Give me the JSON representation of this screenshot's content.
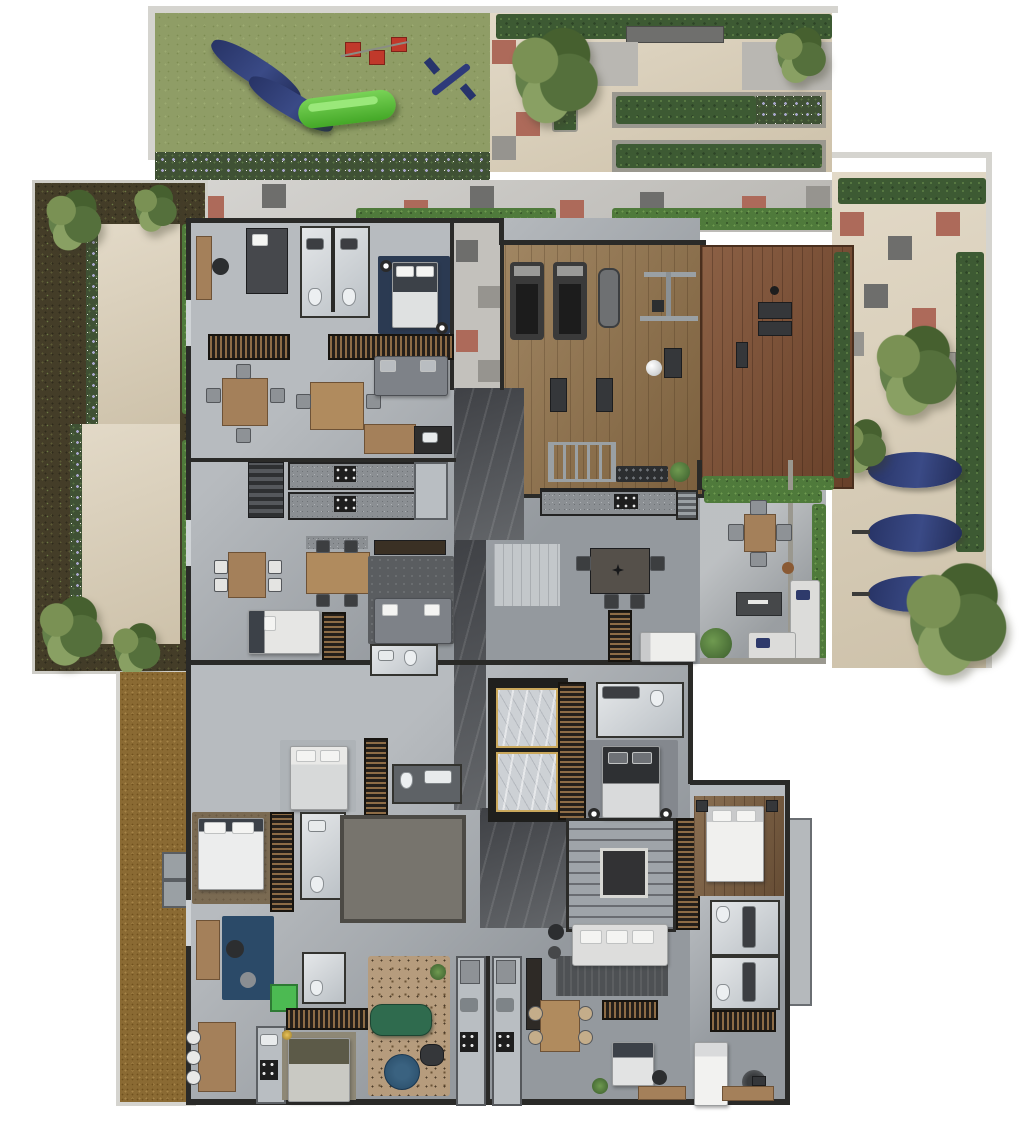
{
  "image_type": "architectural-floor-plan-render",
  "orientation": "top-down",
  "palette": {
    "page_bg": "#ffffff",
    "grass": "#8f9d66",
    "hedge_dark": "#3d5a33",
    "hedge_bright": "#4f7a3b",
    "garden_shrubs": "#443d28",
    "gravel_mulch": "#8a6a33",
    "paving_beige": "#d9cdb5",
    "paving_gray": "#c6c4bf",
    "tile_red": "#ad6a5a",
    "tile_dark": "#6b6b69",
    "concrete_floor": "#a3a8ad",
    "walls": "#2a2a28",
    "gym_wood": "#8d6f49",
    "deck_wood": "#7c4e33",
    "marble_dark": "#56595d",
    "marble_light": "#cdd1d5",
    "navy_fabric": "#2e3a6b",
    "rug_navy": "#2b3a52",
    "rug_office_blue": "#2b4a68",
    "sofa_green": "#2f6b4e",
    "cabinet_green": "#4cba52",
    "slide_green": "#5abe3c",
    "swing_red": "#c0392b",
    "furniture_wood": "#a4805a"
  },
  "outdoor_areas": {
    "playground": {
      "surface": "grass",
      "items": [
        "blue-lounger",
        "blue-lounger",
        "green-slide",
        "swing-red-seat",
        "swing-red-seat",
        "swing-red-seat",
        "seesaw"
      ]
    },
    "top_patio": {
      "surface": "beige-paving",
      "items": [
        "hedge-row",
        "bench",
        "tree",
        "planter",
        "planter",
        "planter"
      ]
    },
    "right_patio": {
      "surface": "beige-paving",
      "items": [
        "hedge-row",
        "checker-tiles",
        "bench",
        "navy-lounger",
        "navy-lounger",
        "navy-lounger",
        "tree",
        "tree",
        "tree"
      ]
    },
    "left_garden": {
      "surface": "shrub-bed",
      "items": [
        "palm",
        "palm",
        "palm",
        "palm",
        "terrace-path",
        "flower-border",
        "flower-border"
      ]
    },
    "mulch_strip": {
      "surface": "brown-gravel",
      "items": [
        "ac-pad",
        "ac-pad"
      ]
    },
    "lounge_terrace": {
      "surface": "concrete",
      "items": [
        "outdoor-table",
        "chairs-4",
        "fire-pit",
        "l-sofa-white",
        "plant"
      ]
    }
  },
  "indoor_areas": {
    "gym": {
      "floor": "light-wood",
      "items": [
        "treadmill",
        "treadmill",
        "elliptical",
        "cable-station",
        "exercise-mat",
        "exercise-mat",
        "gym-ball",
        "ladder-rack",
        "dumbbell-rack",
        "plant"
      ]
    },
    "yoga_deck": {
      "floor": "dark-wood",
      "items": [
        "yoga-mat",
        "yoga-mat",
        "hedge-border"
      ]
    },
    "corridor": {
      "floor": "dark-marble",
      "items": [
        "checker-hallway"
      ]
    },
    "core": {
      "items": [
        "elevator",
        "elevator",
        "switchback-stairs"
      ]
    },
    "apartments": [
      {
        "id": "top-left",
        "items": [
          "desk",
          "wardrobe",
          "bathroom",
          "bathroom",
          "bed-navy-rug",
          "dining-table",
          "dining-table",
          "sofa",
          "kitchen"
        ]
      },
      {
        "id": "mid-left",
        "items": [
          "galley-kitchen",
          "galley-kitchen",
          "fridge",
          "island",
          "dining-table",
          "dining-table",
          "sofa",
          "bed",
          "wardrobe",
          "bathroom"
        ]
      },
      {
        "id": "mid-right",
        "items": [
          "wardrobe",
          "bed",
          "bathroom",
          "bed-dark"
        ]
      },
      {
        "id": "bottom-left",
        "items": [
          "bed",
          "bathroom",
          "master-bed",
          "wardrobe",
          "office-desk-blue-rug",
          "dining-table",
          "kitchen",
          "green-cabinet",
          "bed",
          "green-sofa",
          "leopard-rug",
          "round-table"
        ]
      },
      {
        "id": "bottom-center",
        "items": [
          "white-sectional-sofa",
          "galley-kitchen",
          "galley-kitchen",
          "dining-table",
          "bed",
          "desk"
        ]
      },
      {
        "id": "bottom-right",
        "items": [
          "bed",
          "bathroom",
          "bathroom",
          "wardrobe",
          "single-bed",
          "desk",
          "balcony"
        ]
      }
    ]
  },
  "counts": {
    "navy_loungers": 3,
    "playground_loungers": 2,
    "treadmills": 2,
    "elevators": 2,
    "trees_right_patio": 3,
    "red_swing_seats": 3
  }
}
